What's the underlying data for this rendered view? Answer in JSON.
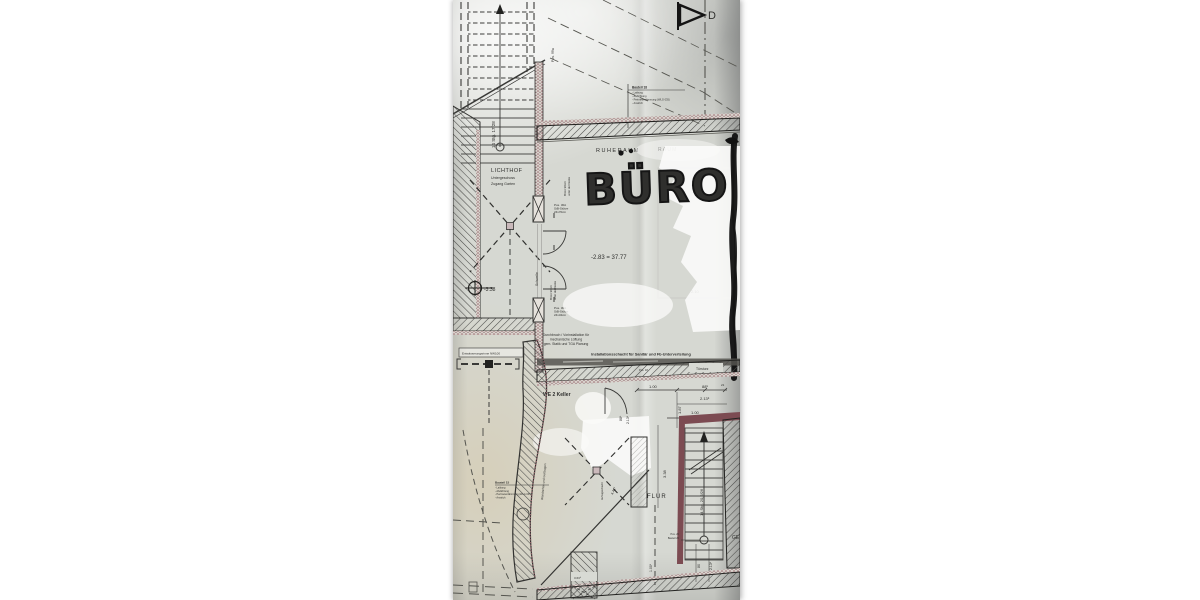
{
  "photo": {
    "rooms": {
      "lichthof": {
        "name": "LICHTHOF",
        "line2": "Untergeschoss",
        "line3": "Zugang Garten"
      },
      "ruheraum": "RUHERAUM",
      "hidden_room": "RAUM",
      "buero_handwritten": "BÜRO",
      "flur": "FLUR",
      "we2_keller": "WE 2 Keller"
    },
    "levels": {
      "buero": "-2.83 = 37.77",
      "lichthof": "-3.38"
    },
    "stairs": {
      "outdoor": "14 Stg. 17/28",
      "cellar": "14 Stg. 20,2/26"
    },
    "annotations": {
      "pos99a": "Pos. 99a",
      "schwelle": "Schwelle",
      "tuersturz": "Türsturz",
      "pos18": "Pos. 18",
      "brh_line1": "BrHö 90cm",
      "brh_line2": "unter der Decke",
      "column_top": {
        "l1": "Pos. 30A",
        "l2": "StB-Stütze",
        "l3": "24x70cm"
      },
      "column_bottom": {
        "l1": "Pos. 30A",
        "l2": "StB-Stütze",
        "l3": "24x34cm"
      },
      "durchbruch": {
        "l1": "Durchbruch / Vorinstallation für",
        "l2": "mechanische Lüftung",
        "l3": "gem. Statik und TGA Planung"
      },
      "schacht": "Installationsschacht für Sanitär und Fb-Unterverteilung",
      "entwaesserung": "Entwässerungsrinne NW100",
      "bauteil18": {
        "title": "Bauteil 18",
        "l1": "- Laibung",
        "l2": "- Abdichtung",
        "l3": "- Perimeterdämmung (WLG 035)",
        "l4": "- Anstrich"
      },
      "bauteil15": {
        "title": "Bauteil 15",
        "l1": "- Laibung",
        "l2": "- Abdichtung",
        "l3": "- Perimeterdämmung (WLG 035)",
        "l4": "- Anstrich"
      },
      "pos20": "Pos. 20",
      "bauteil20": "Bauteil 20",
      "ge": "GE",
      "wall_note": "Wandachse und Gurtbogen",
      "shaft_note": "Aufzugsschacht",
      "section_marker": "D",
      "ghost_dim": "2.10"
    },
    "dimensions": {
      "a": "1.00",
      "b": "88⁵",
      "c": "2.13⁵",
      "d": "1.87",
      "e": "1.00",
      "f": "3.38",
      "g": "4.41⁵",
      "h": "80",
      "i": "2.13⁵",
      "j": "1.00⁵",
      "k": "21",
      "l": "26",
      "m": "3.63⁵"
    }
  },
  "colors": {
    "paper": "#d6d8d2",
    "ink": "#3a3a38",
    "masonry": "#7c4b52",
    "speckle": "#96666c",
    "marker": "#111111",
    "whiteout": "#fbfbf9"
  }
}
